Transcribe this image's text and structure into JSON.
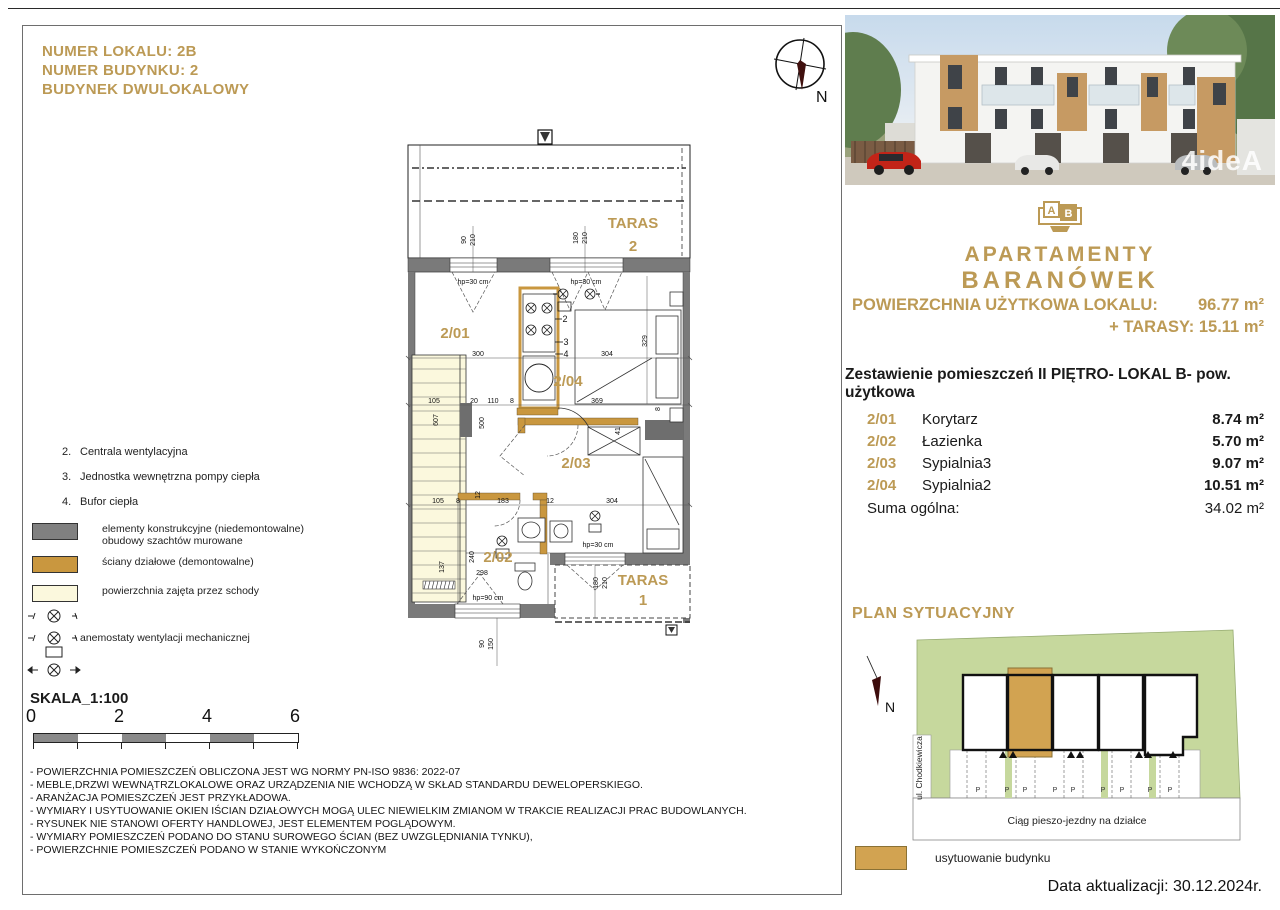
{
  "colors": {
    "gold": "#bc9a55",
    "wall_gray": "#7a7a7a",
    "partition_gold": "#c9973f",
    "stairs_cream": "#fbf8dd",
    "site_green": "#c6d89d",
    "site_gold": "#d2a351"
  },
  "header": {
    "line1": "NUMER LOKALU: 2B",
    "line2": "NUMER BUDYNKU: 2",
    "line3": "BUDYNEK DWULOKALOWY"
  },
  "compass": {
    "north": "N"
  },
  "photo": {
    "watermark": "4ideA"
  },
  "logo": {
    "letter_a": "A",
    "letter_b": "B",
    "line1": "APARTAMENTY",
    "line2": "BARANÓWEK"
  },
  "area_summary": {
    "label": "POWIERZCHNIA UŻYTKOWA LOKALU:",
    "value": "96.77 m²",
    "taras": "+ TARASY: 15.11 m²"
  },
  "room_table": {
    "title": "Zestawienie pomieszczeń II PIĘTRO- LOKAL B- pow. użytkowa",
    "rows": [
      {
        "code": "2/01",
        "name": "Korytarz",
        "area": "8.74 m²"
      },
      {
        "code": "2/02",
        "name": "Łazienka",
        "area": "5.70 m²"
      },
      {
        "code": "2/03",
        "name": "Sypialnia3",
        "area": "9.07 m²"
      },
      {
        "code": "2/04",
        "name": "Sypialnia2",
        "area": "10.51 m²"
      }
    ],
    "sum_label": "Suma ogólna:",
    "sum_value": "34.02 m²"
  },
  "plan": {
    "room_labels": [
      {
        "t": "2/01",
        "x": 55,
        "y": 212
      },
      {
        "t": "2/04",
        "x": 168,
        "y": 260
      },
      {
        "t": "2/03",
        "x": 176,
        "y": 342
      },
      {
        "t": "2/02",
        "x": 98,
        "y": 436
      },
      {
        "t": "TARAS",
        "x": 233,
        "y": 102,
        "s": 19
      },
      {
        "t": "2",
        "x": 233,
        "y": 125,
        "s": 19
      },
      {
        "t": "TARAS",
        "x": 243,
        "y": 459,
        "s": 16
      },
      {
        "t": "1",
        "x": 243,
        "y": 479,
        "s": 16
      }
    ],
    "equip_labels": [
      {
        "t": "2",
        "x": 165,
        "y": 196
      },
      {
        "t": "3",
        "x": 166,
        "y": 219
      },
      {
        "t": "4",
        "x": 166,
        "y": 231
      }
    ],
    "dim_labels": [
      {
        "t": "90",
        "x": 66,
        "y": 114,
        "r": 1
      },
      {
        "t": "210",
        "x": 75,
        "y": 114,
        "r": 1
      },
      {
        "t": "180",
        "x": 178,
        "y": 112,
        "r": 1
      },
      {
        "t": "210",
        "x": 187,
        "y": 112,
        "r": 1
      },
      {
        "t": "hp=30 cm",
        "x": 73,
        "y": 158
      },
      {
        "t": "hp=30 cm",
        "x": 186,
        "y": 158
      },
      {
        "t": "300",
        "x": 78,
        "y": 230
      },
      {
        "t": "304",
        "x": 207,
        "y": 230
      },
      {
        "t": "329",
        "x": 247,
        "y": 215,
        "r": 1
      },
      {
        "t": "500",
        "x": 84,
        "y": 297,
        "r": 1
      },
      {
        "t": "105",
        "x": 34,
        "y": 277
      },
      {
        "t": "20",
        "x": 74,
        "y": 277
      },
      {
        "t": "110",
        "x": 93,
        "y": 277
      },
      {
        "t": "8",
        "x": 112,
        "y": 277
      },
      {
        "t": "369",
        "x": 197,
        "y": 277
      },
      {
        "t": "8",
        "x": 260,
        "y": 283,
        "r": 1
      },
      {
        "t": "607",
        "x": 38,
        "y": 294,
        "r": 1
      },
      {
        "t": "41",
        "x": 220,
        "y": 305,
        "r": 1
      },
      {
        "t": "105",
        "x": 38,
        "y": 377
      },
      {
        "t": "8",
        "x": 58,
        "y": 377
      },
      {
        "t": "183",
        "x": 103,
        "y": 377
      },
      {
        "t": "12",
        "x": 150,
        "y": 377
      },
      {
        "t": "304",
        "x": 212,
        "y": 377
      },
      {
        "t": "12",
        "x": 80,
        "y": 369,
        "r": 1
      },
      {
        "t": "137",
        "x": 44,
        "y": 441,
        "r": 1
      },
      {
        "t": "240",
        "x": 74,
        "y": 431,
        "r": 1
      },
      {
        "t": "298",
        "x": 82,
        "y": 449
      },
      {
        "t": "hp=90 cm",
        "x": 88,
        "y": 474
      },
      {
        "t": "hp=30 cm",
        "x": 198,
        "y": 421
      },
      {
        "t": "180",
        "x": 198,
        "y": 457,
        "r": 1
      },
      {
        "t": "210",
        "x": 207,
        "y": 457,
        "r": 1
      },
      {
        "t": "90",
        "x": 84,
        "y": 518,
        "r": 1
      },
      {
        "t": "150",
        "x": 93,
        "y": 518,
        "r": 1
      }
    ]
  },
  "legend": {
    "notes": [
      {
        "num": "2.",
        "text": "Centrala wentylacyjna"
      },
      {
        "num": "3.",
        "text": "Jednostka wewnętrzna pompy ciepła"
      },
      {
        "num": "4.",
        "text": "Bufor ciepła"
      }
    ],
    "swatches": [
      {
        "label1": "elementy konstrukcyjne (niedemontowalne)",
        "label2": "obudowy szachtów murowane"
      },
      {
        "label1": "ściany działowe (demontowalne)"
      },
      {
        "label1": "powierzchnia zajęta przez schody"
      }
    ],
    "anemostat": "anemostaty wentylacji mechanicznej"
  },
  "scale": {
    "title": "SKALA_1:100",
    "labels": [
      "0",
      "2",
      "4",
      "6"
    ]
  },
  "notes": {
    "lines": [
      "- POWIERZCHNIA POMIESZCZEŃ OBLICZONA JEST WG NORMY PN-ISO 9836: 2022-07",
      "- MEBLE,DRZWI WEWNĄTRZLOKALOWE ORAZ URZĄDZENIA NIE WCHODZĄ W SKŁAD STANDARDU DEWELOPERSKIEGO.",
      "- ARANŻACJA POMIESZCZEŃ JEST PRZYKŁADOWA.",
      "- WYMIARY I USYTUOWANIE OKIEN IŚCIAN DZIAŁOWYCH MOGĄ ULEC NIEWIELKIM ZMIANOM W TRAKCIE REALIZACJI PRAC BUDOWLANYCH.",
      "- RYSUNEK NIE STANOWI OFERTY HANDLOWEJ, JEST ELEMENTEM POGLĄDOWYM.",
      "- WYMIARY POMIESZCZEŃ PODANO DO STANU SUROWEGO ŚCIAN (BEZ UWZGLĘDNIANIA TYNKU),",
      "- POWIERZCHNIE POMIESZCZEŃ PODANO W STANIE WYKOŃCZONYM"
    ]
  },
  "siteplan": {
    "title": "PLAN SYTUACYJNY",
    "street": "ul. Chodkiewicza",
    "road": "Ciąg pieszo-jezdny na działce",
    "north": "N",
    "legend": "usytuowanie budynku",
    "parking_labels": [
      {
        "t": "P",
        "x": 123,
        "y": 164
      },
      {
        "t": "P",
        "x": 152,
        "y": 164
      },
      {
        "t": "P",
        "x": 170,
        "y": 164
      },
      {
        "t": "P",
        "x": 200,
        "y": 164
      },
      {
        "t": "P",
        "x": 218,
        "y": 164
      },
      {
        "t": "P",
        "x": 248,
        "y": 164
      },
      {
        "t": "P",
        "x": 267,
        "y": 164
      },
      {
        "t": "P",
        "x": 295,
        "y": 164
      },
      {
        "t": "P",
        "x": 315,
        "y": 164
      }
    ]
  },
  "footer": {
    "date": "Data aktualizacji: 30.12.2024r."
  }
}
